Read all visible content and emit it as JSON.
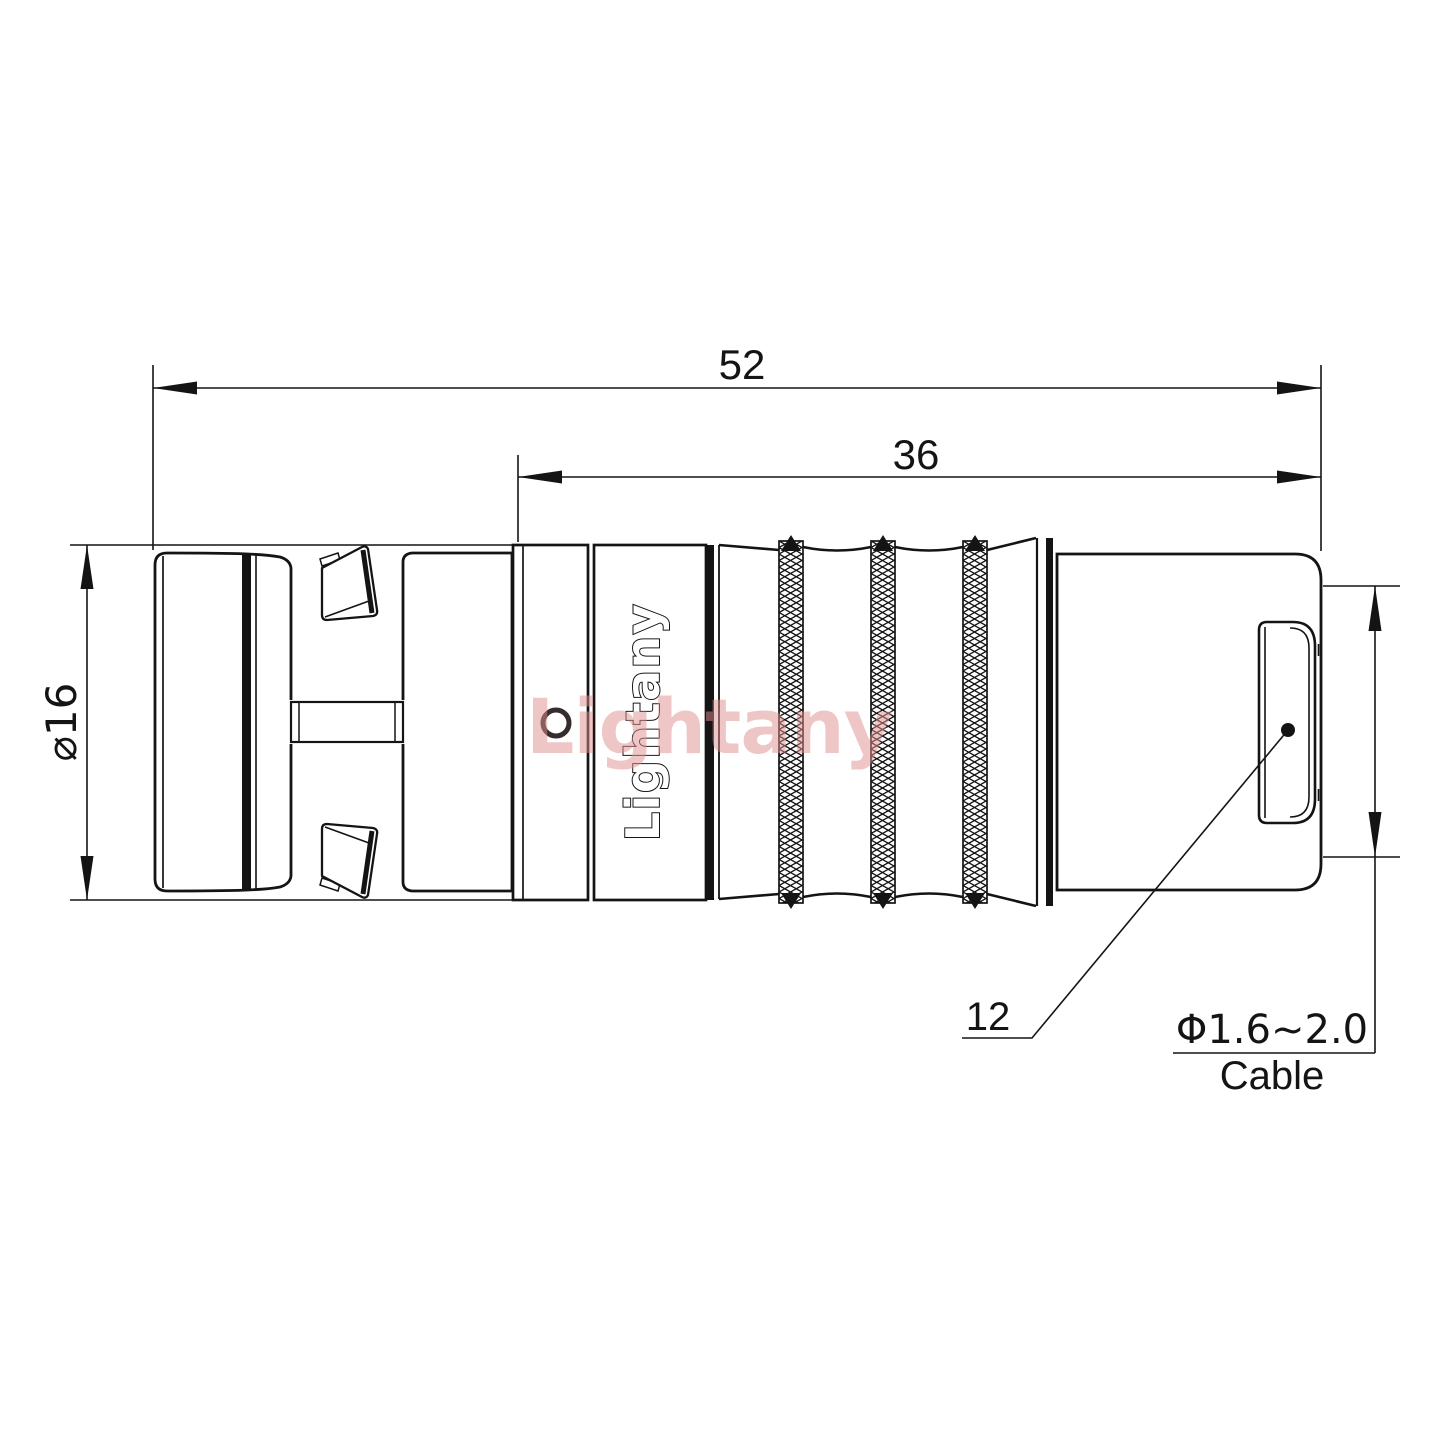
{
  "drawing": {
    "type": "connector-technical-drawing",
    "watermark": "Lightany",
    "logo": "Lightany",
    "dimensions": {
      "overall_length": "52",
      "body_length": "36",
      "front_diameter": "⌀16",
      "rear_part_label": "12",
      "cable_spec": "Φ1.6~2.0",
      "cable_word": "Cable"
    },
    "colors": {
      "line": "#141414",
      "watermark_red": "#e18e8e",
      "background": "#ffffff"
    }
  }
}
